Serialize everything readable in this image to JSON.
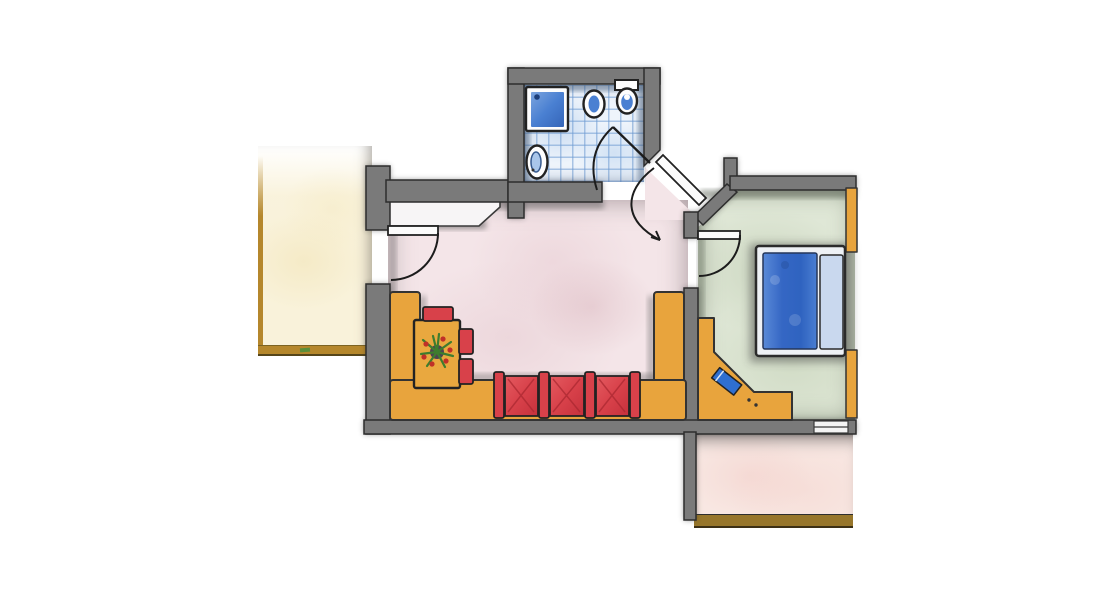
{
  "document": {
    "title": "Hand-drawn apartment floor plan (colored pencil)"
  },
  "colors": {
    "outline": "#2b2b2b",
    "wall": "#7a7a7a",
    "wallShadow": "#303030",
    "livingFloor": "#f4e5e8",
    "bedroomFloor": "#dfe7d6",
    "bathFloor": "#eef4fb",
    "terraceLeftFloor": "#f9f2da",
    "terraceLeftBorder": "#b5872c",
    "terraceBottomFloor": "#f8e7e2",
    "terraceBottomBorder": "#97762b",
    "bench": "#e8a43d",
    "benchEdge": "#333333",
    "seatRed": "#d8414a",
    "seatRedDark": "#a8262f",
    "table": "#e9a83f",
    "bedFrame": "#eef1f5",
    "bedBlanket": "#3c72c8",
    "bedPillow": "#c9d8ee",
    "stoolBlue": "#2f6fd0",
    "fixtureBlue": "#4a80d2",
    "fixtureBlueLight": "#a9c6ea",
    "plantGreen": "#3e7d2e",
    "plantRed": "#c03028",
    "doorLeaf": "#fbfbfb"
  },
  "rooms": {
    "bathroom": {
      "name": "Bathroom (blue tiled floor)"
    },
    "living": {
      "name": "Living room"
    },
    "bedroom": {
      "name": "Bedroom"
    },
    "entry": {
      "name": "Entrance hall"
    },
    "niche": {
      "name": "Wardrobe niche"
    },
    "terraceLeft": {
      "name": "Terrace (left)"
    },
    "terraceLower": {
      "name": "Terrace (lower)"
    }
  },
  "furniture": {
    "shower": {
      "name": "Shower tray"
    },
    "washbasin": {
      "name": "Wash basin"
    },
    "toilet": {
      "name": "Toilet with cistern"
    },
    "bidet": {
      "name": "Bidet"
    },
    "benchLeft": {
      "name": "Corner bench (left)"
    },
    "benchBottom": {
      "name": "Corner bench (bottom)"
    },
    "benchRight": {
      "name": "Corner bench (right)"
    },
    "table": {
      "name": "Table with plant"
    },
    "chairTop": {
      "name": "Chair"
    },
    "chairRight1": {
      "name": "Chair"
    },
    "chairRight2": {
      "name": "Chair"
    },
    "sofa": {
      "name": "Three-seat sofa"
    },
    "desk": {
      "name": "Desk / vanity"
    },
    "stool": {
      "name": "Stool"
    },
    "bed": {
      "name": "Double bed"
    },
    "wardrobeTop": {
      "name": "Wardrobe (top right)"
    },
    "wardrobeBottom": {
      "name": "Wardrobe (bottom right)"
    },
    "plant": {
      "name": "Potted plant"
    }
  },
  "doors": {
    "entranceDoor": {
      "name": "Apartment entrance door (diagonal)"
    },
    "bathroomDoor": {
      "name": "Bathroom door"
    },
    "bedroomDoor": {
      "name": "Bedroom door"
    },
    "terraceDoor": {
      "name": "Terrace door"
    }
  }
}
